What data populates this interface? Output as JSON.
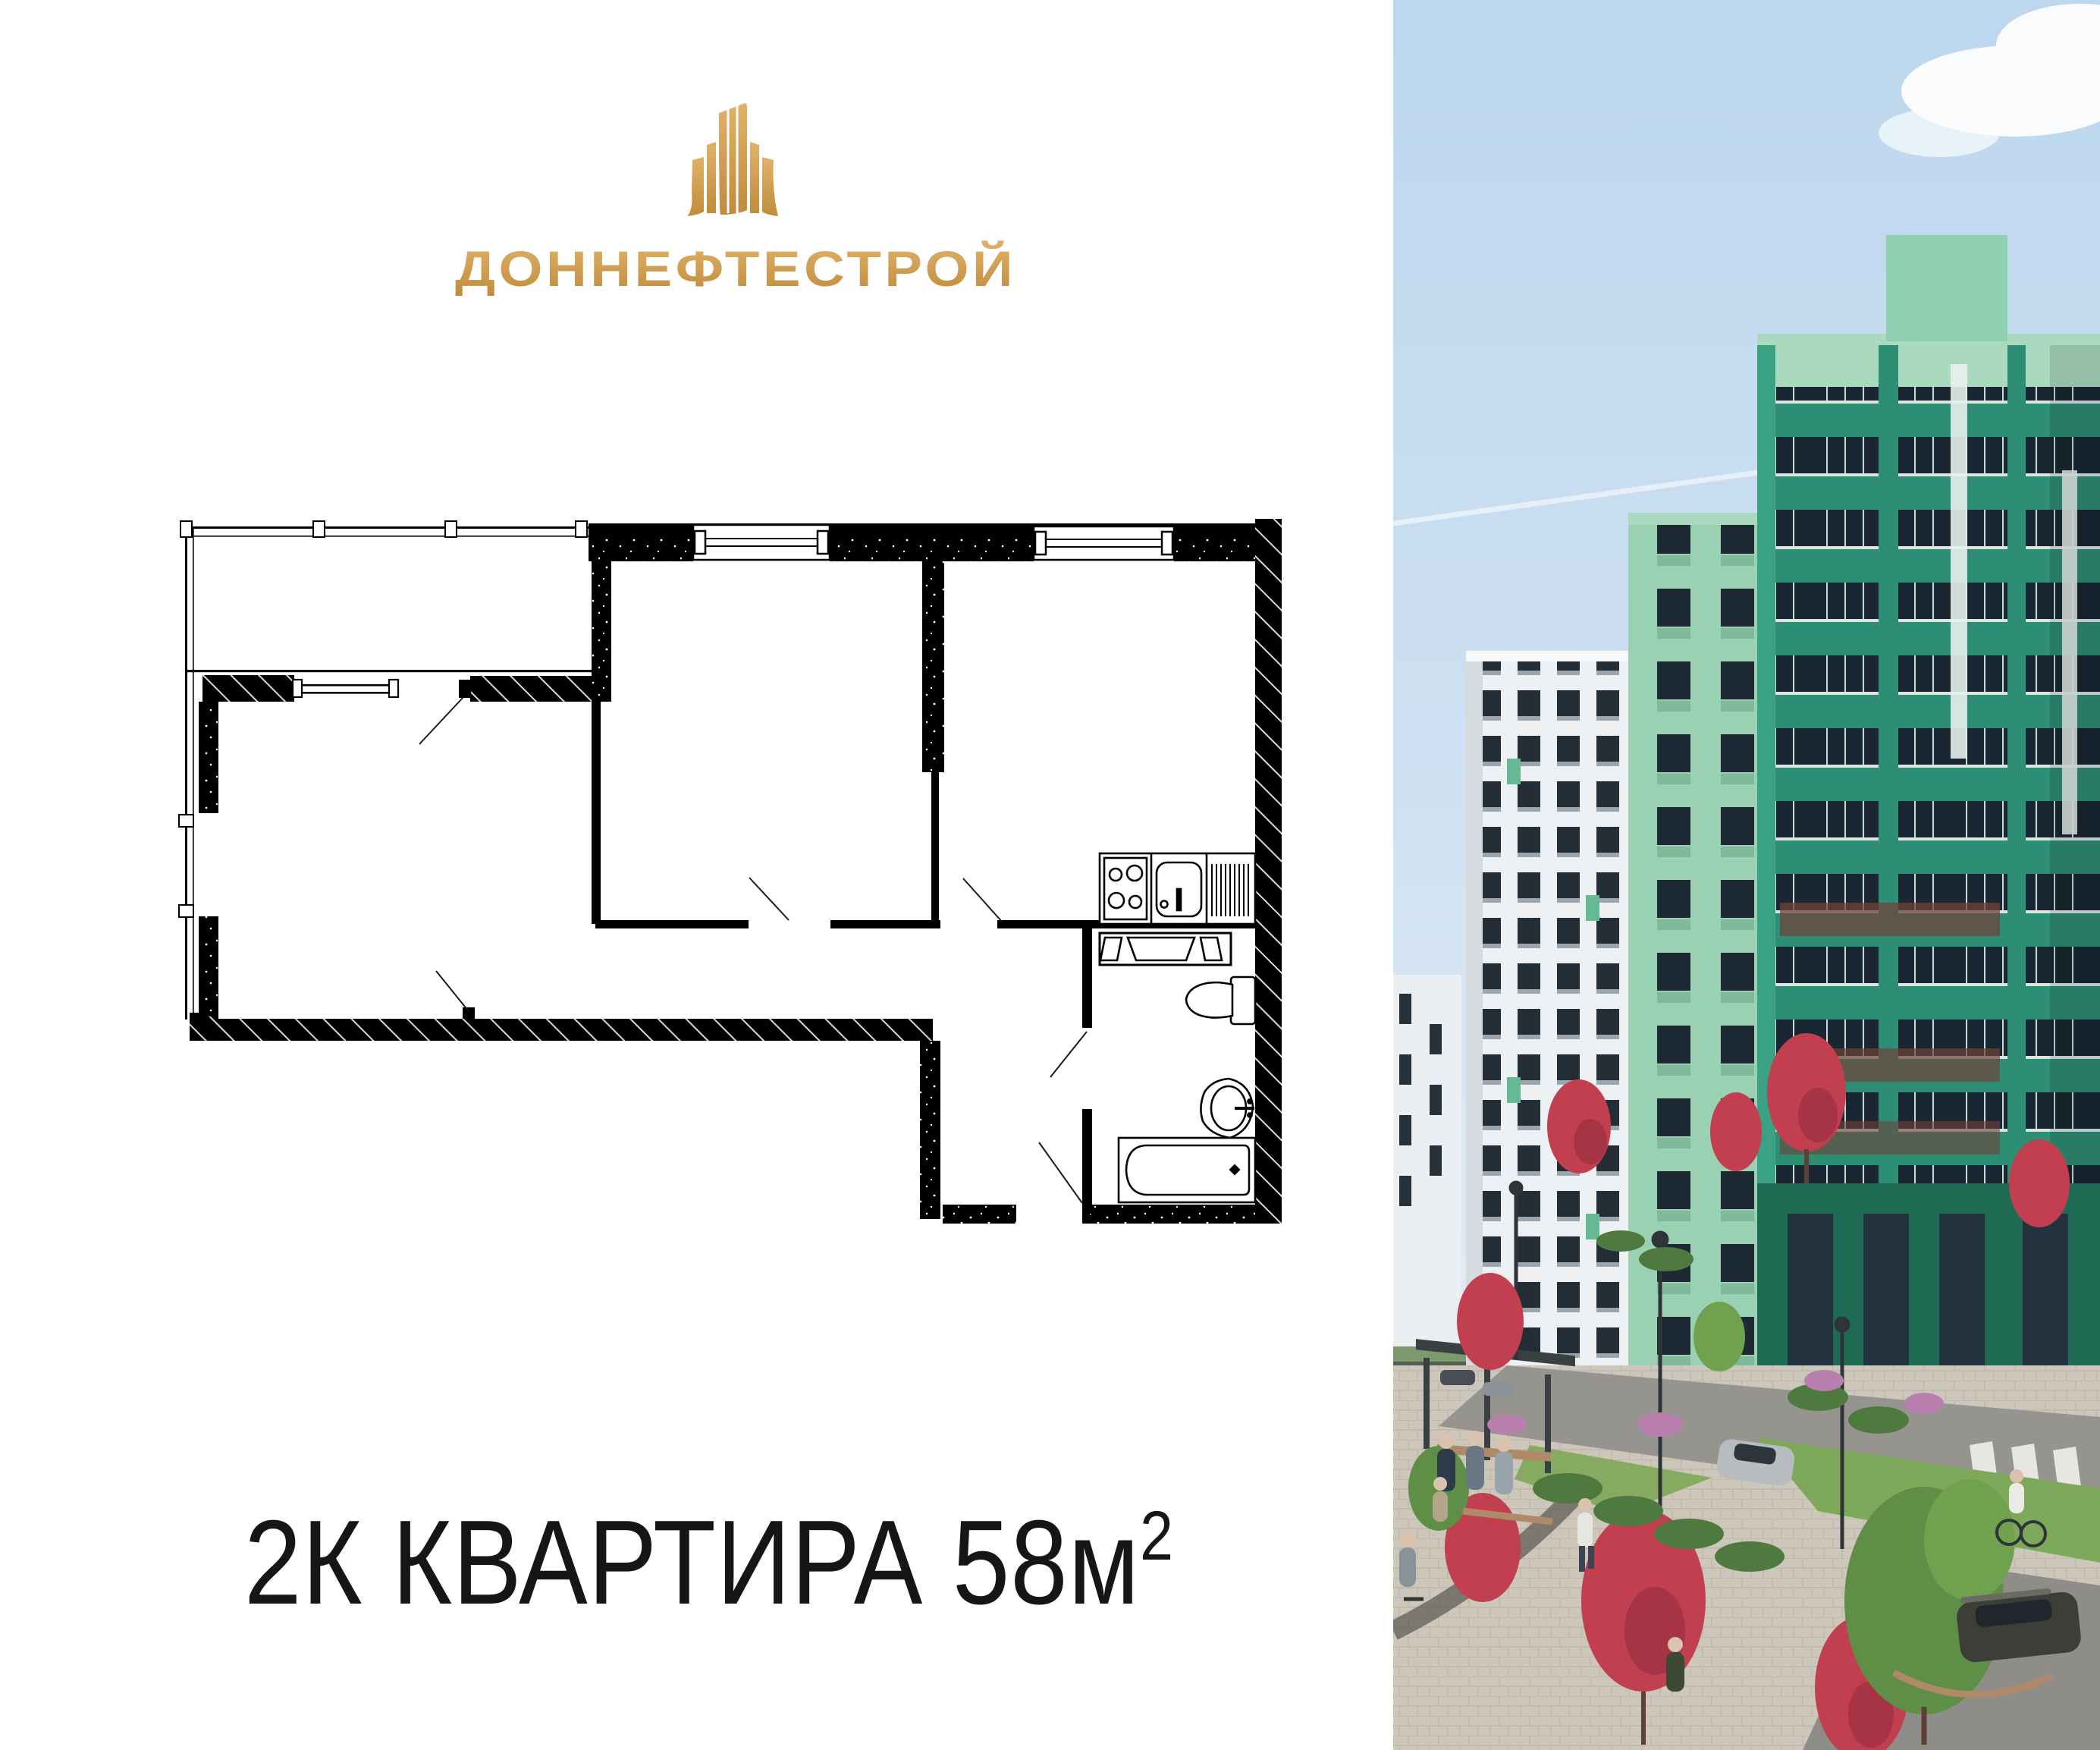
{
  "brand": {
    "name": "ДОННЕФТЕСТРОЙ",
    "logo_icon": "gold-buildings",
    "colors": {
      "gold_light": "#e2b369",
      "gold": "#d2a051",
      "gold_dark": "#c08c3c"
    }
  },
  "headline": {
    "main": "2К КВАРТИРА 58",
    "unit": "м",
    "superscript": "2",
    "full_text": "2К КВАРТИРА 58м²"
  },
  "floor_plan": {
    "kind": "2-room apartment plan, black line drawing on white",
    "wall_color": "#000000",
    "fixtures": [
      "stove-4-burners",
      "kitchen-sink",
      "drainer",
      "vent-shaft",
      "toilet",
      "washbasin",
      "bathtub"
    ],
    "features": [
      "glazed-balcony-left",
      "bedroom-window-top",
      "kitchen-window-top",
      "door-swings",
      "hatched-outer-walls"
    ]
  },
  "photo": {
    "kind": "residential complex render",
    "palette": {
      "sky_top": "#bcd7ee",
      "sky_bottom": "#dde9f3",
      "green_tower": "#2e8e74",
      "green_tower_light": "#9ad1b2",
      "green_parapet": "#a9dabd",
      "window_band": "#1a2733",
      "white_tower": "#eef1f3",
      "red_tree": "#c23f50",
      "green_tree": "#5f8f46",
      "lawn": "#7fa95a",
      "road": "#92908b",
      "pavement": "#cdc7bb",
      "suv": "#3e3e38",
      "silver_car": "#b9bcbe"
    }
  }
}
